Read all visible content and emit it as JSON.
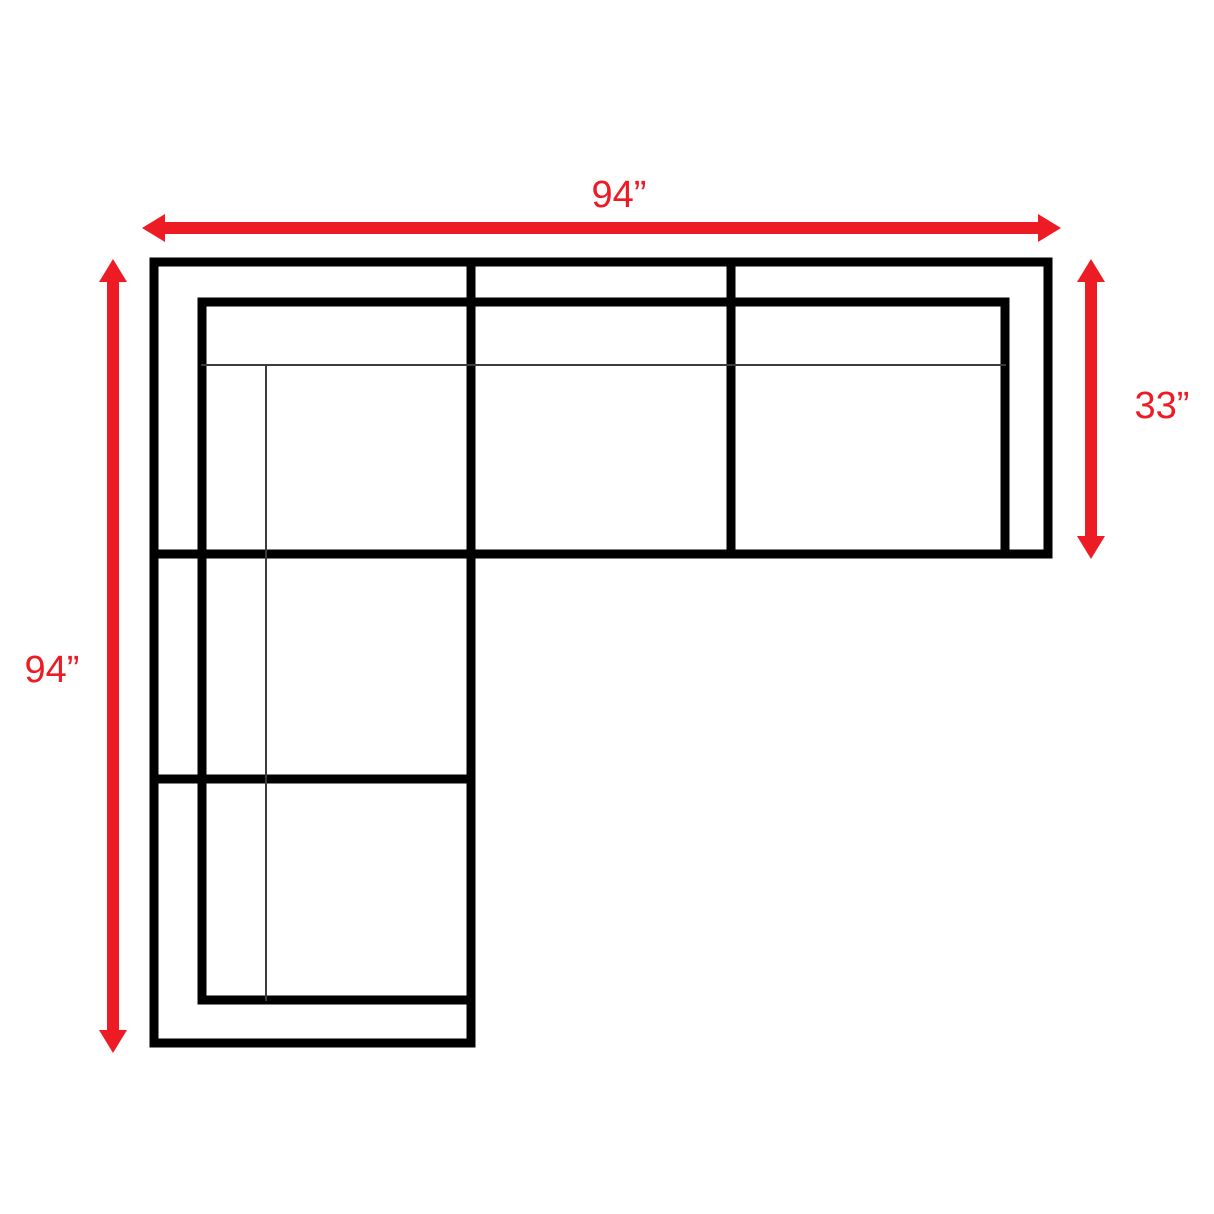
{
  "diagram": {
    "title": "sectional-sofa-top-view-dimension-diagram",
    "labels": {
      "top_width": "94”",
      "left_height": "94”",
      "right_depth": "33”"
    },
    "dimensions_inches": {
      "top_width": 94,
      "left_height": 94,
      "right_depth": 33
    },
    "colors": {
      "arrow": "#ed1c24",
      "label_text": "#ed1c24",
      "outline": "#000000",
      "cushion_line": "#3c3c3c",
      "background": "#ffffff"
    }
  }
}
